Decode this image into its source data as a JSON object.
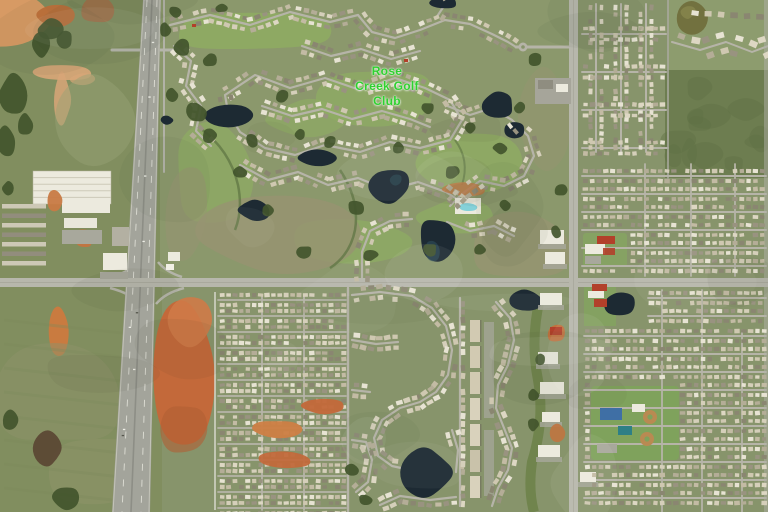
{
  "map": {
    "type": "satellite-aerial-imagery",
    "place_label": {
      "name": "Rose Creek Golf Club",
      "lines": [
        "Rose",
        "Creek Golf",
        "Club"
      ],
      "color": "#2fd12f"
    },
    "features": {
      "golf_course": "Rose Creek Golf Club community with ponds and fairways",
      "highway": "north-south divided highway on the west side",
      "arterial_roads": "east-west section road mid-image, north-south road on east side",
      "land_use": "suburban residential grids, farmland with red dirt patches, commercial pads"
    },
    "palette": {
      "land_base": "#87946b",
      "land_left": "#818e5f",
      "field_light": "#96a276",
      "fairway": "#8fae62",
      "scrub": "#979472",
      "dark_field": "#6d7d50",
      "trees_dark": "#42552c",
      "trees_red": "#5a4733",
      "pond_dark": "#1d2a33",
      "pond_teal": "#2e4f5c",
      "pond_brown": "#72713f",
      "road_light": "#b7b7ac",
      "street": "#b6b4a8",
      "highway": "#a3a49b",
      "lane_marking": "#e8e8df",
      "dirt_orange": "#c3693a",
      "dirt_bright": "#c0703a",
      "dirt_pale": "#d8a678",
      "dirt_salmon": "#d79a64",
      "building_white": "#eceade",
      "roof_red": "#b2402a",
      "roof_blue": "#3f6fa5",
      "roof_teal": "#2e7f86",
      "pool_teal": "#7fd0d8",
      "lawn_green": "#7fa25c",
      "parking_gray": "#a8a89c",
      "ball_field": "#b98a52"
    }
  }
}
